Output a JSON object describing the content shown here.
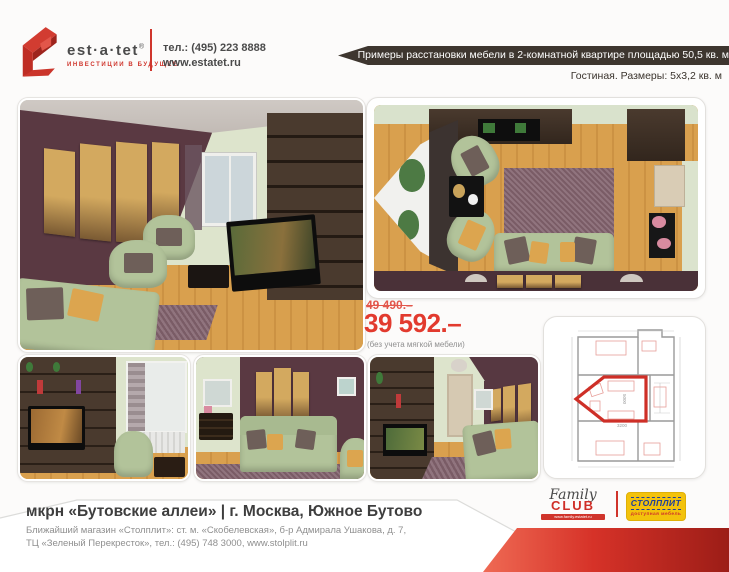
{
  "header": {
    "logo": {
      "name": "est·a·tet",
      "reg": "®",
      "tagline": "ИНВЕСТИЦИИ В БУДУЩЕЕ"
    },
    "contact": {
      "phone": "тел.: (495) 223 8888",
      "site": "www.estatet.ru"
    },
    "banner": "Примеры расстановки мебели в 2-комнатной квартире площадью 50,5 кв. м",
    "subtitle": "Гостиная. Размеры: 5х3,2 кв. м"
  },
  "pricing": {
    "old_price": "49 490.–",
    "price": "39 592.–",
    "note": "(без учета мягкой мебели)"
  },
  "images": {
    "main_alt": "Гостиная — общий вид с диваном, креслами и стенкой с ТВ",
    "overhead_alt": "Гостиная — вид сверху, 3D-планировка расстановки мебели",
    "photo1_alt": "Стенка с ТВ и кресло у окна",
    "photo2_alt": "Диван у бордовой стены с картинами",
    "photo3_alt": "Гостиная — вид вдоль комнаты на дверь",
    "floorplan_alt": "План квартиры с выделенной гостиной"
  },
  "floorplan": {
    "dim_vertical": "5000",
    "dim_horizontal": "3200"
  },
  "footer": {
    "title": "мкрн «Бутовские аллеи» | г. Москва, Южное Бутово",
    "address_line1": "Ближайший магазин «Столплит»: ст. м. «Скобелевская», б-р Адмирала Ушакова, д. 7,",
    "address_line2": "ТЦ «Зеленый Перекресток», тел.: (495) 748 3000, www.stolplit.ru",
    "family_club": {
      "family": "Family",
      "club": "CLUB",
      "site": "www.family.estatet.ru"
    },
    "stolplit": {
      "name": "СТОЛПЛИТ",
      "tagline": "доступная мебель"
    }
  },
  "colors": {
    "accent_red": "#cf352c",
    "banner_bg": "#3e362f",
    "price_red": "#e23a2e",
    "stolplit_yellow": "#f3c20c",
    "stolplit_blue": "#1e3e9c"
  }
}
